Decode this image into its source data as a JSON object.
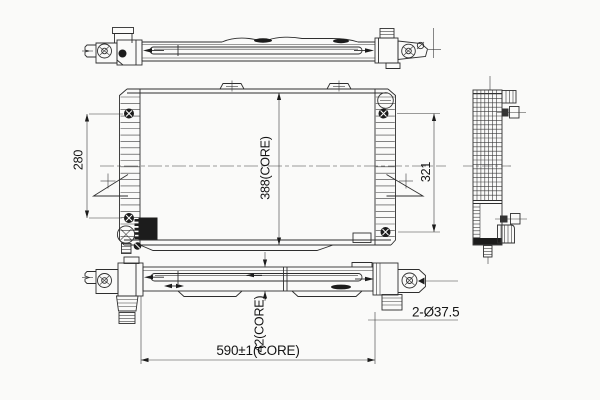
{
  "drawing": {
    "kind": "radiator-technical-line-drawing",
    "background_color": "#fafaf9",
    "line_color": "#2e2e2e",
    "views": [
      "top-view",
      "front-view",
      "side-view",
      "bottom-view"
    ]
  },
  "dimensions": {
    "left_mount_height": "280",
    "core_height": "388(CORE)",
    "right_mount_height": "321",
    "core_depth": "42(CORE)",
    "core_width": "590±1(CORE)",
    "pipe_diameter": "2-Ø37.5"
  }
}
